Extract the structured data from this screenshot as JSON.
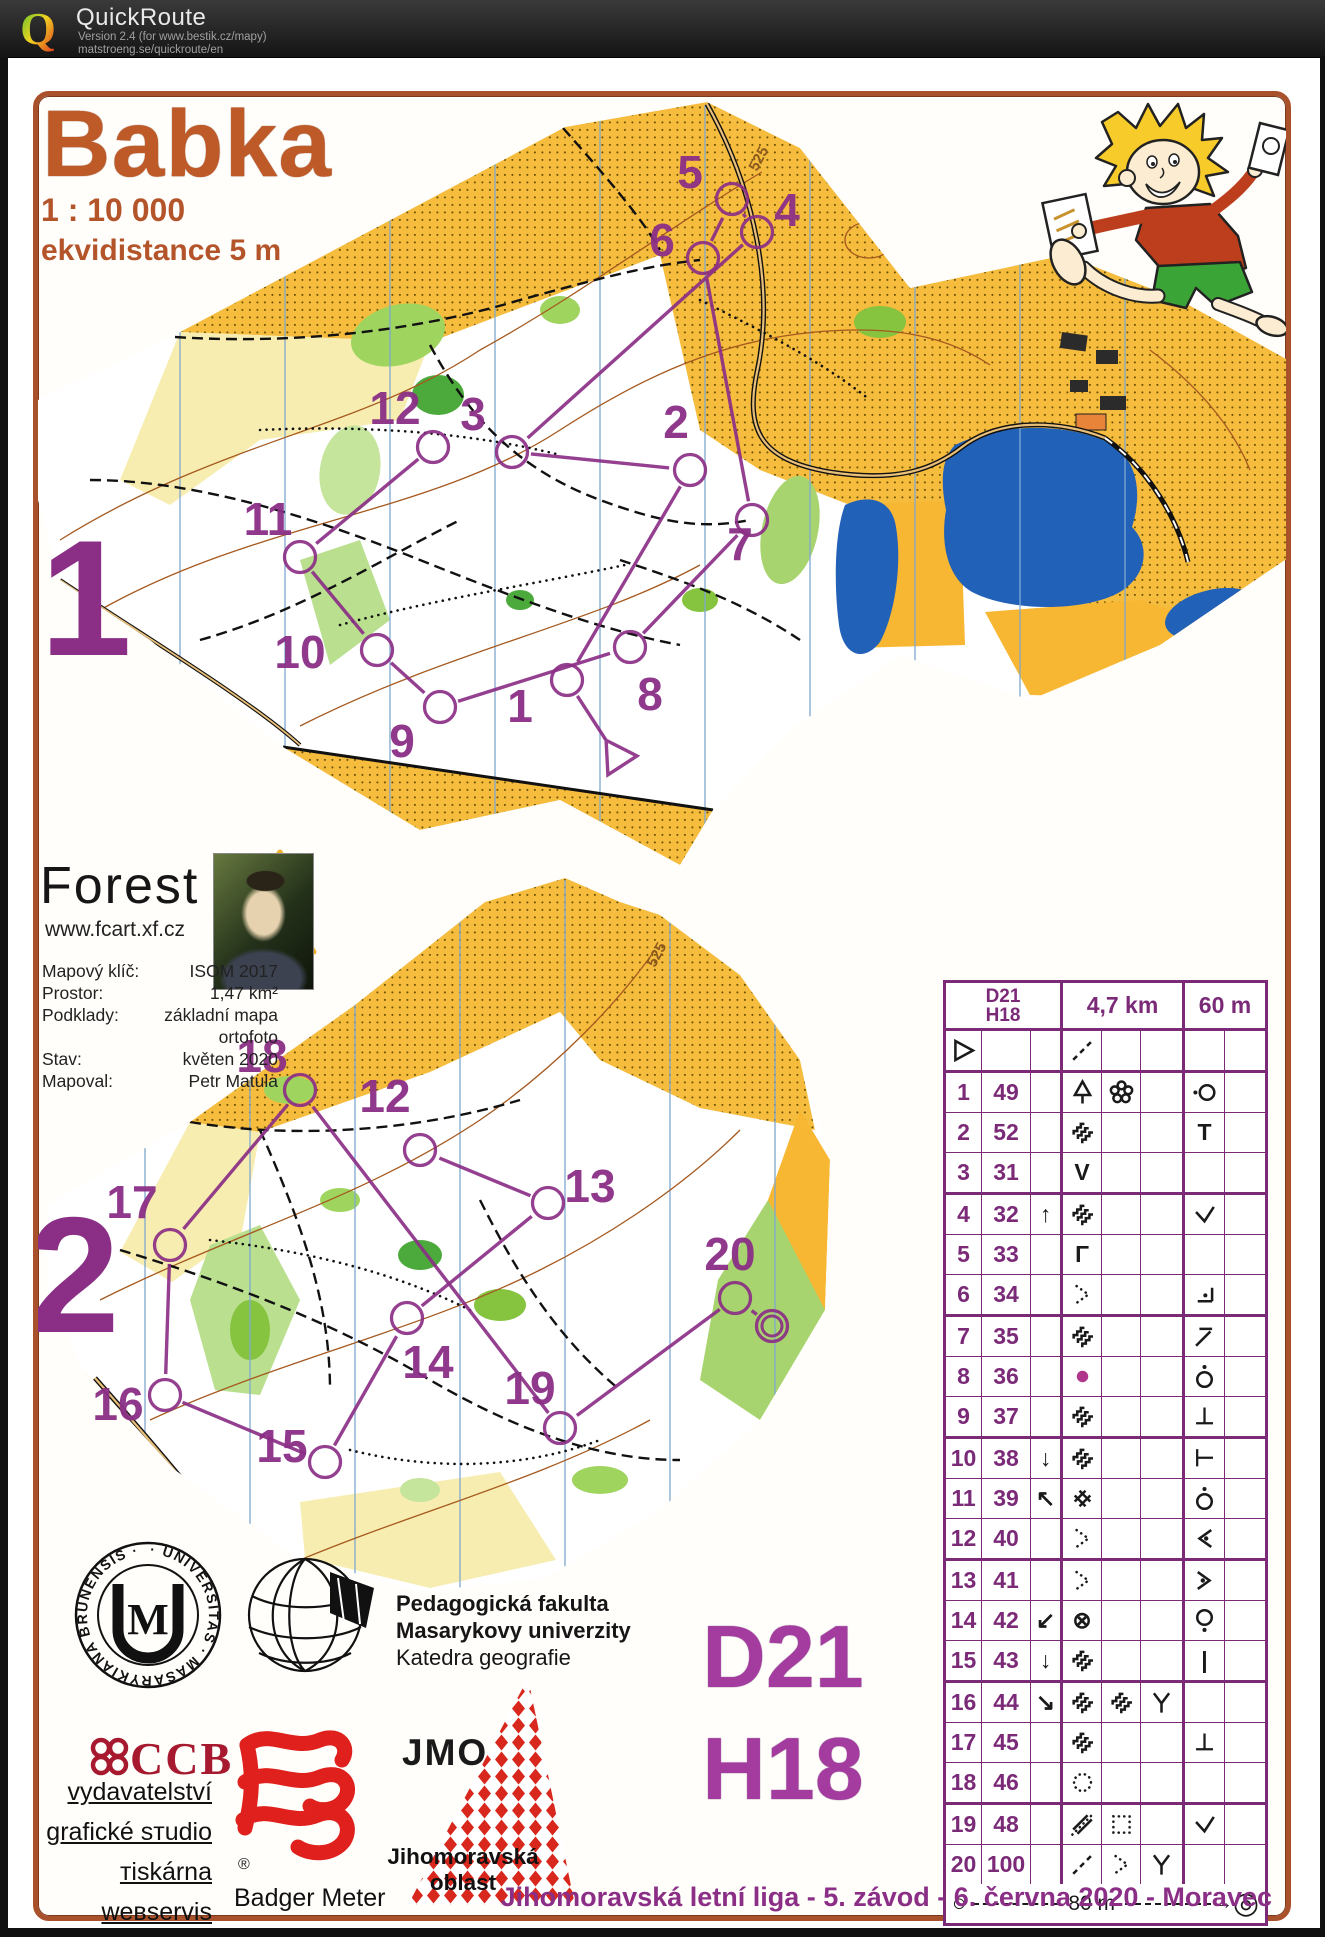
{
  "window": {
    "app_title": "QuickRoute",
    "version_line": "Version 2.4  (for www.bestik.cz/mapy)",
    "link_line": "matstroeng.se/quickroute/en",
    "logo_letter": "Q"
  },
  "doc": {
    "title": "Babka",
    "scale": "1 : 10 000",
    "equidistance": "ekvidistance 5 m",
    "footer": "Jihomoravská letní liga - 5. závod - 6. června 2020 - Moravec",
    "class_big": {
      "line1": "D21",
      "line2": "H18"
    },
    "forest": {
      "name": "Forest",
      "url": "www.fcart.xf.cz"
    },
    "meta": [
      {
        "label": "Mapový klíč:",
        "value": "ISOM 2017"
      },
      {
        "label": "Prostor:",
        "value": "1,47 km²"
      },
      {
        "label": "Podklady:",
        "value": "základní mapa"
      },
      {
        "label": "",
        "value": "ortofoto"
      },
      {
        "label": "Stav:",
        "value": "květen 2020"
      },
      {
        "label": "Mapoval:",
        "value": "Petr Matula"
      }
    ],
    "map_labels": [
      {
        "text": "525",
        "x": 757,
        "y": 172,
        "rot": -62
      },
      {
        "text": "525",
        "x": 655,
        "y": 968,
        "rot": -62
      }
    ],
    "course1": {
      "big_label": {
        "text": "1",
        "x": 40,
        "y": 655,
        "size": 165
      },
      "start": {
        "x": 617,
        "y": 757
      },
      "controls": [
        {
          "n": "1",
          "cx": 567,
          "cy": 680,
          "lx": 520,
          "ly": 722
        },
        {
          "n": "2",
          "cx": 690,
          "cy": 470,
          "lx": 676,
          "ly": 438
        },
        {
          "n": "3",
          "cx": 512,
          "cy": 452,
          "lx": 473,
          "ly": 430
        },
        {
          "n": "4",
          "cx": 757,
          "cy": 232,
          "lx": 787,
          "ly": 226
        },
        {
          "n": "5",
          "cx": 732,
          "cy": 199,
          "lx": 690,
          "ly": 188
        },
        {
          "n": "6",
          "cx": 703,
          "cy": 258,
          "lx": 662,
          "ly": 256
        },
        {
          "n": "7",
          "cx": 752,
          "cy": 520,
          "lx": 740,
          "ly": 560
        },
        {
          "n": "8",
          "cx": 630,
          "cy": 647,
          "lx": 650,
          "ly": 710
        },
        {
          "n": "9",
          "cx": 440,
          "cy": 707,
          "lx": 402,
          "ly": 757
        },
        {
          "n": "10",
          "cx": 377,
          "cy": 650,
          "lx": 300,
          "ly": 668
        },
        {
          "n": "11",
          "cx": 300,
          "cy": 557,
          "lx": 268,
          "ly": 535
        },
        {
          "n": "12",
          "cx": 433,
          "cy": 447,
          "lx": 395,
          "ly": 424
        }
      ]
    },
    "course2": {
      "big_label": {
        "text": "2",
        "x": 28,
        "y": 1332,
        "size": 165
      },
      "controls": [
        {
          "n": "12",
          "cx": 420,
          "cy": 1150,
          "lx": 385,
          "ly": 1112
        },
        {
          "n": "13",
          "cx": 548,
          "cy": 1203,
          "lx": 590,
          "ly": 1202
        },
        {
          "n": "14",
          "cx": 407,
          "cy": 1318,
          "lx": 428,
          "ly": 1378
        },
        {
          "n": "15",
          "cx": 325,
          "cy": 1462,
          "lx": 282,
          "ly": 1462
        },
        {
          "n": "16",
          "cx": 165,
          "cy": 1395,
          "lx": 118,
          "ly": 1420
        },
        {
          "n": "17",
          "cx": 170,
          "cy": 1245,
          "lx": 132,
          "ly": 1218
        },
        {
          "n": "18",
          "cx": 300,
          "cy": 1090,
          "lx": 262,
          "ly": 1072
        },
        {
          "n": "19",
          "cx": 560,
          "cy": 1428,
          "lx": 530,
          "ly": 1404
        },
        {
          "n": "20",
          "cx": 735,
          "cy": 1298,
          "lx": 730,
          "ly": 1270
        },
        {
          "n": "F",
          "cx": 772,
          "cy": 1326,
          "finish": true
        }
      ]
    }
  },
  "card": {
    "header": {
      "klass1": "D21",
      "klass2": "H18",
      "length": "4,7 km",
      "climb": "60 m"
    },
    "rows": [
      {
        "a": "svg:start",
        "b": "",
        "c": "",
        "d": "svg:dashdiag",
        "e": "",
        "f": "",
        "g": "",
        "h": ""
      },
      {
        "a": "1",
        "b": "49",
        "c": "",
        "d": "svg:tree",
        "e": "svg:flower",
        "f": "",
        "g": "svg:cdotl",
        "h": ""
      },
      {
        "a": "2",
        "b": "52",
        "c": "",
        "d": "svg:marsh",
        "e": "",
        "f": "",
        "g": "T",
        "h": ""
      },
      {
        "a": "3",
        "b": "31",
        "c": "",
        "d": "V",
        "e": "",
        "f": "",
        "g": "",
        "h": ""
      },
      {
        "a": "4",
        "b": "32",
        "c": "↑",
        "d": "svg:marsh",
        "e": "",
        "f": "",
        "g": "svg:check",
        "h": ""
      },
      {
        "a": "5",
        "b": "33",
        "c": "",
        "d": "Γ",
        "e": "",
        "f": "",
        "g": "",
        "h": ""
      },
      {
        "a": "6",
        "b": "34",
        "c": "",
        "d": "svg:chevdots",
        "e": "",
        "f": "",
        "g": "svg:cornerdot",
        "h": ""
      },
      {
        "a": "7",
        "b": "35",
        "c": "",
        "d": "svg:marsh",
        "e": "",
        "f": "",
        "g": "svg:hookne",
        "h": ""
      },
      {
        "a": "8",
        "b": "36",
        "c": "",
        "d": "svg:dot",
        "e": "",
        "f": "",
        "g": "svg:cdota",
        "h": ""
      },
      {
        "a": "9",
        "b": "37",
        "c": "",
        "d": "svg:marsh",
        "e": "",
        "f": "",
        "g": "⊥",
        "h": ""
      },
      {
        "a": "10",
        "b": "38",
        "c": "↓",
        "d": "svg:marsh",
        "e": "",
        "f": "",
        "g": "⊢",
        "h": ""
      },
      {
        "a": "11",
        "b": "39",
        "c": "↖",
        "d": "svg:hash",
        "e": "",
        "f": "",
        "g": "svg:cdota",
        "h": ""
      },
      {
        "a": "12",
        "b": "40",
        "c": "",
        "d": "svg:chevdots",
        "e": "",
        "f": "",
        "g": "svg:ltdot",
        "h": ""
      },
      {
        "a": "13",
        "b": "41",
        "c": "",
        "d": "svg:chevdots",
        "e": "",
        "f": "",
        "g": "svg:gtdot",
        "h": ""
      },
      {
        "a": "14",
        "b": "42",
        "c": "↙",
        "d": "⊗",
        "e": "",
        "f": "",
        "g": "svg:cdotb",
        "h": ""
      },
      {
        "a": "15",
        "b": "43",
        "c": "↓",
        "d": "svg:marsh",
        "e": "",
        "f": "",
        "g": "|",
        "h": ""
      },
      {
        "a": "16",
        "b": "44",
        "c": "↘",
        "d": "svg:marsh",
        "e": "svg:marsh",
        "f": "svg:yjunc",
        "g": "",
        "h": ""
      },
      {
        "a": "17",
        "b": "45",
        "c": "",
        "d": "svg:marsh",
        "e": "",
        "f": "",
        "g": "⊥",
        "h": ""
      },
      {
        "a": "18",
        "b": "46",
        "c": "",
        "d": "svg:dotcircle",
        "e": "",
        "f": "",
        "g": "",
        "h": ""
      },
      {
        "a": "19",
        "b": "48",
        "c": "",
        "d": "svg:linesdots",
        "e": "svg:dotsquare",
        "f": "",
        "g": "svg:check",
        "h": ""
      },
      {
        "a": "20",
        "b": "100",
        "c": "",
        "d": "svg:dashdiag",
        "e": "svg:chevdots",
        "f": "svg:yjunc",
        "g": "",
        "h": ""
      }
    ],
    "scale_row": {
      "start_symbol": "○",
      "finish_symbol": "◎",
      "arrow": "→",
      "label": "80 m"
    }
  },
  "sponsors": {
    "seal_text": "· UNIVERSITAS · MASARYKIANA BRUNENSIS ·",
    "seal_monogram": "M",
    "faculty": [
      "Pedagogická fakulta",
      "Masarykovy univerzity",
      "Katedra geografie"
    ],
    "ccb": {
      "name": "CCB",
      "lines": [
        "vydavatelství",
        "grafické sтudio",
        "тiskárna",
        "weвservis"
      ]
    },
    "badger": {
      "reg": "®",
      "name": "Badger Meter"
    },
    "jmo": {
      "name": "JMO",
      "line1": "Jihomoravská",
      "line2": "oblast"
    }
  },
  "colors": {
    "accent_purple": "#8B2F86",
    "card_grid": "#7B2A78",
    "title_brown": "#BE5A28",
    "lake_blue": "#2261B8",
    "open_yellow": "#F6BC3E",
    "ccb_red": "#A6192E",
    "badger_red": "#E0201C"
  }
}
